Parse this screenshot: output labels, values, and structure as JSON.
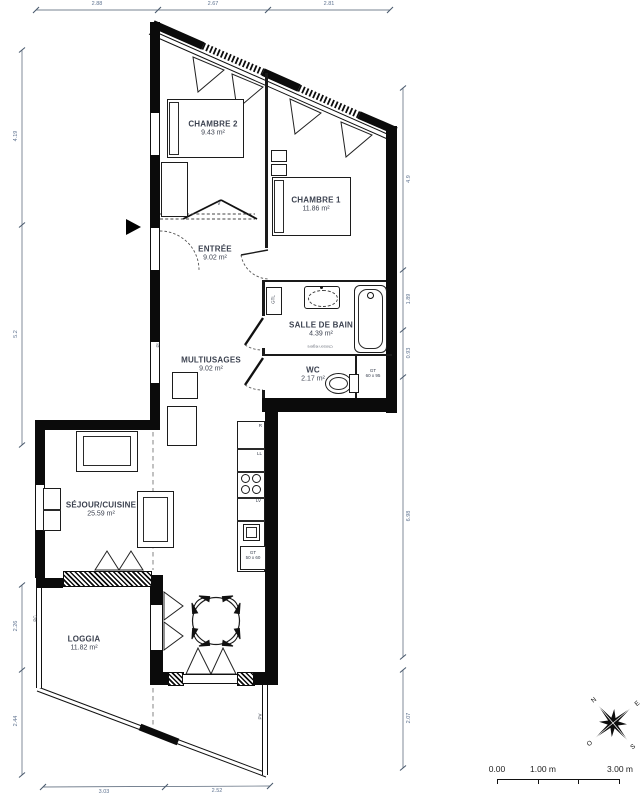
{
  "page": {
    "background": "#ffffff",
    "ink": "#0b0b0b",
    "label_color": "#3c4250",
    "dim_color": "#5f7390"
  },
  "rooms": {
    "chambre2": {
      "label": "CHAMBRE 2",
      "area": "9.43 m²"
    },
    "chambre1": {
      "label": "CHAMBRE 1",
      "area": "11.86 m²"
    },
    "entree": {
      "label": "ENTRÉE",
      "area": "9.02 m²"
    },
    "salle_de_bain": {
      "label": "SALLE DE BAIN",
      "area": "4.39 m²"
    },
    "multiusages": {
      "label": "MULTIUSAGES",
      "area": "9.02 m²"
    },
    "wc": {
      "label": "WC",
      "area": "2.17 m²"
    },
    "sejour_cuisine": {
      "label": "SÉJOUR/CUISINE",
      "area": "25.59 m²"
    },
    "loggia": {
      "label": "LOGGIA",
      "area": "11.82 m²"
    }
  },
  "equipment": {
    "gtl": "GTL",
    "gt_wc": "GT",
    "gt_wc_size": "60 x 95",
    "gt_kitchen": "GT",
    "gt_kitchen_size": "50 x 60",
    "fridge": "R",
    "washing_machine": "LL",
    "dishwasher": "LV",
    "wardrobe": "V",
    "partition_note": "Cloison légère",
    "pc": "PC",
    "pv": "PV",
    "pl": "Pl"
  },
  "dimensions": {
    "top": [
      "2.88",
      "2.67",
      "2.81"
    ],
    "left_upper": [
      "4.19",
      "5.2"
    ],
    "left_lower": [
      "2.26",
      "2.44"
    ],
    "right": [
      "4.9",
      "1.89",
      "0.93",
      "6.98",
      "2.07"
    ],
    "bottom": [
      "3.03",
      "2.52"
    ]
  },
  "scale_bar": {
    "zero": "0.00",
    "one": "1.00 m",
    "three": "3.00 m"
  },
  "compass": {
    "n": "N",
    "e": "E",
    "s": "S",
    "o": "O"
  }
}
